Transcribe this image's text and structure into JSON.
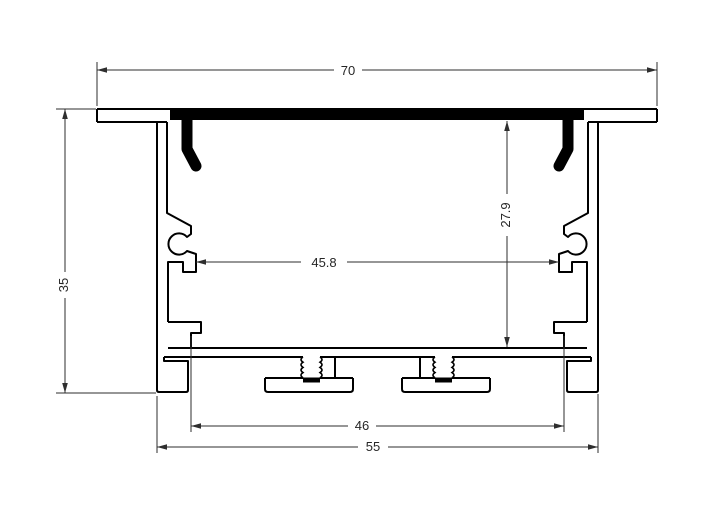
{
  "drawing": {
    "colors": {
      "background": "#ffffff",
      "profile_line": "#000000",
      "dimension_line": "#2e2e2e",
      "cover_strip": "#000000",
      "text": "#262626"
    },
    "dimensions": [
      {
        "id": "top-width",
        "label": "70",
        "axis": "h",
        "pos": 70,
        "from": 97,
        "to": 657,
        "gap": [
          334,
          362
        ],
        "text": {
          "x": 348,
          "y": 70,
          "rotate": 0
        },
        "ext": [
          [
            97,
            62,
            97,
            106
          ],
          [
            657,
            62,
            657,
            106
          ]
        ]
      },
      {
        "id": "overall-height",
        "label": "35",
        "axis": "v",
        "pos": 65,
        "from": 109,
        "to": 393,
        "gap": [
          272,
          298
        ],
        "text": {
          "x": 64,
          "y": 285,
          "rotate": -90
        },
        "ext": [
          [
            56,
            109,
            96,
            109
          ],
          [
            56,
            393,
            156,
            393
          ]
        ]
      },
      {
        "id": "inner-height",
        "label": "27.9",
        "axis": "v",
        "pos": 507,
        "from": 121,
        "to": 347,
        "gap": [
          194,
          236
        ],
        "text": {
          "x": 506,
          "y": 215,
          "rotate": -90
        },
        "ext": []
      },
      {
        "id": "inner-width",
        "label": "45.8",
        "axis": "h",
        "pos": 262,
        "from": 196,
        "to": 559,
        "gap": [
          301,
          347
        ],
        "text": {
          "x": 324,
          "y": 262,
          "rotate": 0
        },
        "ext": []
      },
      {
        "id": "mount-slot-width",
        "label": "46",
        "axis": "h",
        "pos": 426,
        "from": 191,
        "to": 564,
        "gap": [
          348,
          376
        ],
        "text": {
          "x": 362,
          "y": 425,
          "rotate": 0
        },
        "ext": [
          [
            191,
            336,
            191,
            432
          ],
          [
            564,
            336,
            564,
            432
          ]
        ]
      },
      {
        "id": "base-width",
        "label": "55",
        "axis": "h",
        "pos": 447,
        "from": 157,
        "to": 598,
        "gap": [
          358,
          388
        ],
        "text": {
          "x": 373,
          "y": 446,
          "rotate": 0
        },
        "ext": [
          [
            157,
            396,
            157,
            453
          ],
          [
            598,
            394,
            598,
            453
          ]
        ]
      }
    ]
  }
}
